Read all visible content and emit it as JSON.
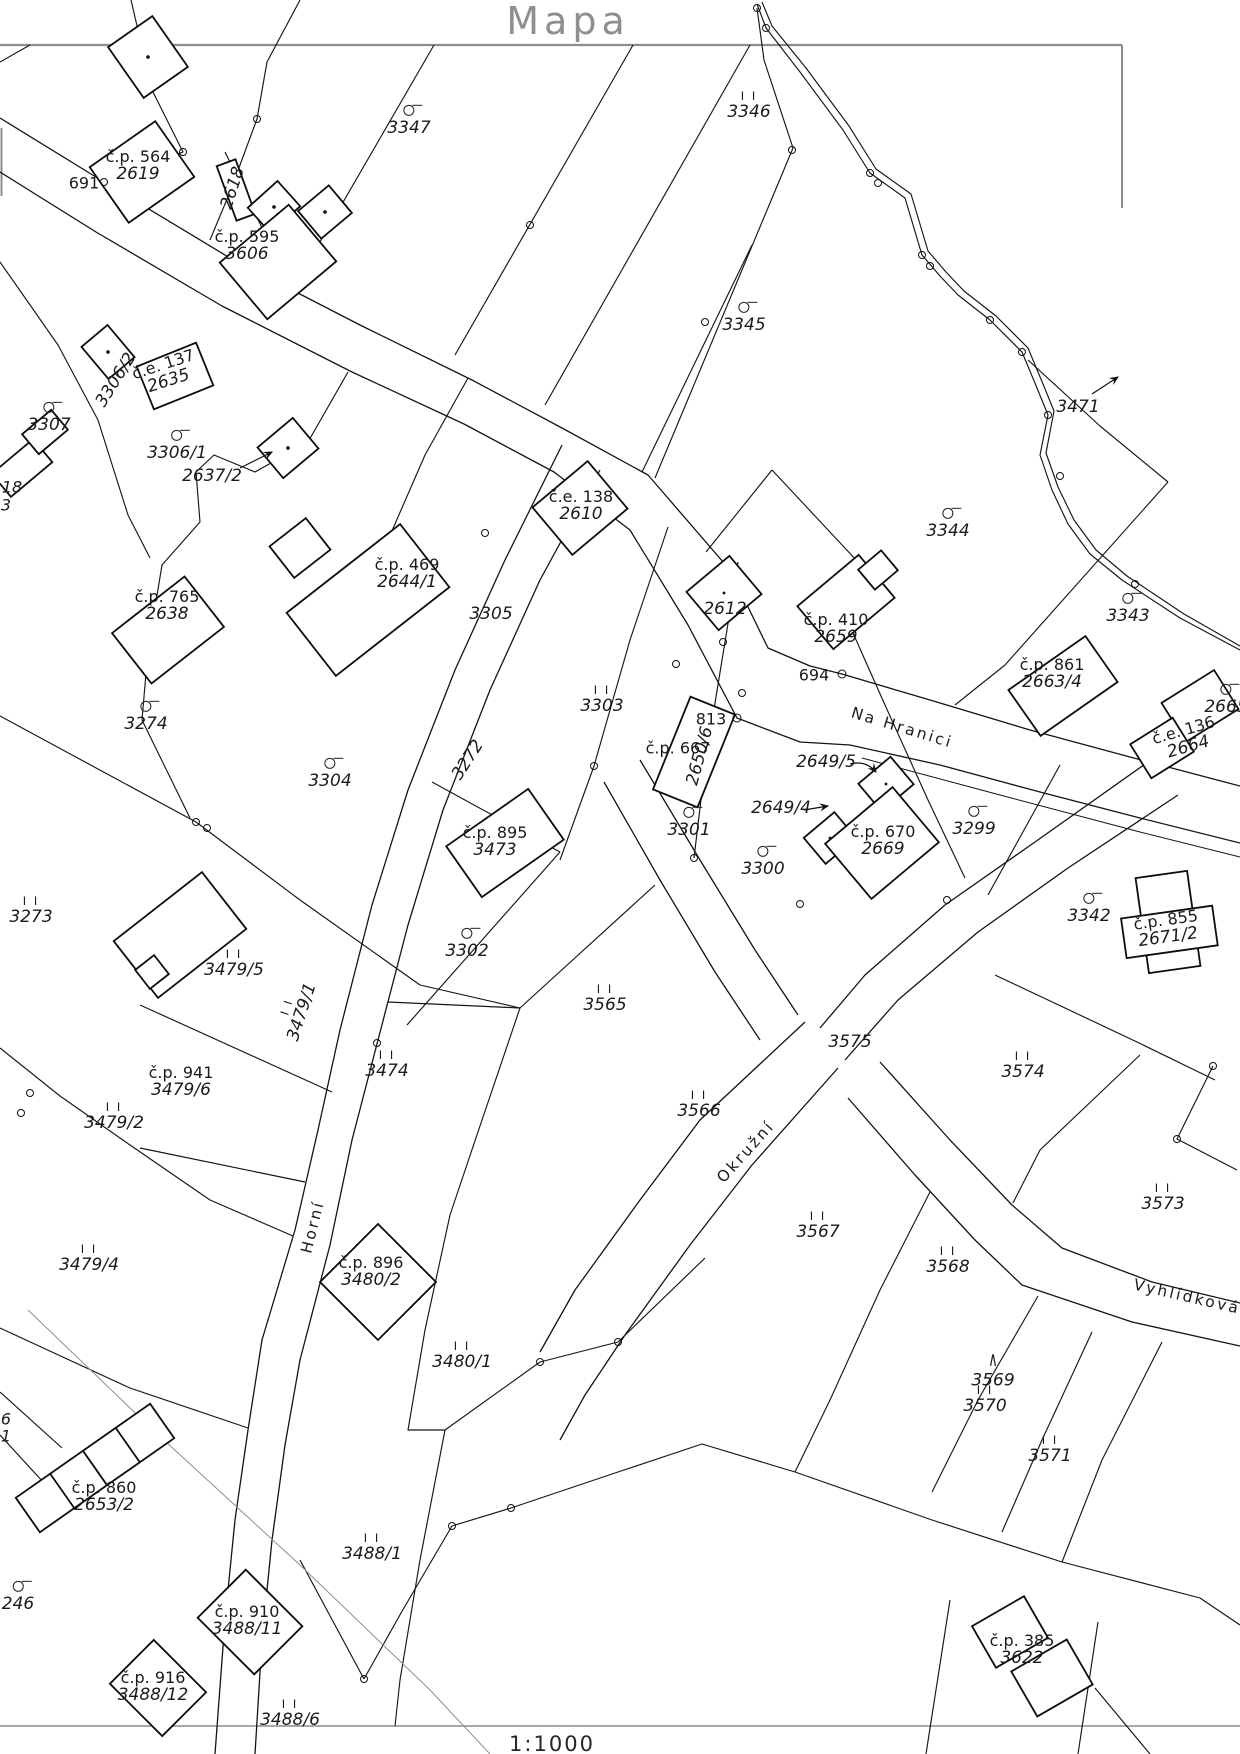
{
  "title": "Mapa",
  "scale_label": "1:1000",
  "streets": [
    {
      "name": "Na Hranici",
      "x": 902,
      "y": 728,
      "rot": 17
    },
    {
      "name": "Okružní",
      "x": 746,
      "y": 1152,
      "rot": -48
    },
    {
      "name": "Horní",
      "x": 313,
      "y": 1227,
      "rot": -76
    },
    {
      "name": "Vyhlídková",
      "x": 1187,
      "y": 1297,
      "rot": 13
    }
  ],
  "parcels": [
    {
      "t": "3347",
      "x": 409,
      "y": 121,
      "s": "c"
    },
    {
      "t": "3346",
      "x": 749,
      "y": 106,
      "s": "g"
    },
    {
      "t": "3345",
      "x": 744,
      "y": 318,
      "s": "c"
    },
    {
      "t": "3471",
      "x": 1078,
      "y": 407
    },
    {
      "t": "3344",
      "x": 948,
      "y": 524,
      "s": "c"
    },
    {
      "t": "3343",
      "x": 1128,
      "y": 609,
      "s": "c"
    },
    {
      "t": "3307",
      "x": 49,
      "y": 418,
      "s": "c"
    },
    {
      "t": "3306/1",
      "x": 177,
      "y": 446,
      "s": "c"
    },
    {
      "t": "3306/2",
      "x": 116,
      "y": 380,
      "rot": -58
    },
    {
      "t": "2637/2",
      "x": 212,
      "y": 476
    },
    {
      "t": "2618",
      "x": 233,
      "y": 188,
      "rot": -72
    },
    {
      "t": "3305",
      "x": 491,
      "y": 614
    },
    {
      "t": "3303",
      "x": 602,
      "y": 700,
      "s": "g"
    },
    {
      "t": "2612",
      "x": 725,
      "y": 609
    },
    {
      "t": "3304",
      "x": 330,
      "y": 774,
      "s": "c"
    },
    {
      "t": "3274",
      "x": 146,
      "y": 717,
      "s": "c"
    },
    {
      "t": "3273",
      "x": 31,
      "y": 911,
      "s": "g"
    },
    {
      "t": "3272",
      "x": 468,
      "y": 760,
      "rot": -57
    },
    {
      "t": "2650/6",
      "x": 700,
      "y": 756,
      "rot": -75
    },
    {
      "t": "2649/5",
      "x": 826,
      "y": 762
    },
    {
      "t": "2649/4",
      "x": 781,
      "y": 808
    },
    {
      "t": "3301",
      "x": 689,
      "y": 823,
      "s": "c"
    },
    {
      "t": "3300",
      "x": 763,
      "y": 862,
      "s": "c"
    },
    {
      "t": "3299",
      "x": 974,
      "y": 822,
      "s": "c"
    },
    {
      "t": "3342",
      "x": 1089,
      "y": 909,
      "s": "c"
    },
    {
      "t": "2665",
      "x": 1226,
      "y": 700,
      "s": "c"
    },
    {
      "t": "3302",
      "x": 467,
      "y": 944,
      "s": "c"
    },
    {
      "t": "3479/5",
      "x": 234,
      "y": 964,
      "s": "g"
    },
    {
      "t": "3479/1",
      "x": 296,
      "y": 1010,
      "s": "g",
      "rot": -72
    },
    {
      "t": "3479/2",
      "x": 114,
      "y": 1117,
      "s": "g"
    },
    {
      "t": "3479/4",
      "x": 89,
      "y": 1259,
      "s": "g"
    },
    {
      "t": "3565",
      "x": 605,
      "y": 999,
      "s": "g"
    },
    {
      "t": "3474",
      "x": 387,
      "y": 1065,
      "s": "g"
    },
    {
      "t": "3566",
      "x": 699,
      "y": 1105,
      "s": "g"
    },
    {
      "t": "3575",
      "x": 850,
      "y": 1042
    },
    {
      "t": "3574",
      "x": 1023,
      "y": 1066,
      "s": "g"
    },
    {
      "t": "3573",
      "x": 1163,
      "y": 1198,
      "s": "g"
    },
    {
      "t": "3567",
      "x": 818,
      "y": 1226,
      "s": "g"
    },
    {
      "t": "3568",
      "x": 948,
      "y": 1261,
      "s": "g"
    },
    {
      "t": "3569",
      "x": 993,
      "y": 1372,
      "s": "t"
    },
    {
      "t": "3570",
      "x": 985,
      "y": 1400,
      "s": "g"
    },
    {
      "t": "3571",
      "x": 1050,
      "y": 1450,
      "s": "g"
    },
    {
      "t": "3480/1",
      "x": 462,
      "y": 1356,
      "s": "g"
    },
    {
      "t": "3488/1",
      "x": 372,
      "y": 1548,
      "s": "g"
    },
    {
      "t": "3488/6",
      "x": 290,
      "y": 1714,
      "s": "g"
    },
    {
      "t": "246",
      "x": 18,
      "y": 1597,
      "s": "c"
    }
  ],
  "buildings": [
    {
      "a": "č.p. 564",
      "b": "2619",
      "x": 138,
      "y": 166
    },
    {
      "a": "č.p. 595",
      "b": "3606",
      "x": 247,
      "y": 246
    },
    {
      "a": "č.e. 137",
      "b": "2635",
      "x": 166,
      "y": 373,
      "rot": -18
    },
    {
      "a": "č.e. 138",
      "b": "2610",
      "x": 581,
      "y": 506
    },
    {
      "a": "č.p. 469",
      "b": "2644/1",
      "x": 407,
      "y": 574
    },
    {
      "a": "č.p. 765",
      "b": "2638",
      "x": 167,
      "y": 606
    },
    {
      "a": "č.p. 410",
      "b": "2659",
      "x": 836,
      "y": 629
    },
    {
      "a": "č.p. 667",
      "b": "",
      "x": 678,
      "y": 748
    },
    {
      "a": "č.p. 861",
      "b": "2663/4",
      "x": 1052,
      "y": 674
    },
    {
      "a": "č.e. 136",
      "b": "2664",
      "x": 1186,
      "y": 739,
      "rot": -16
    },
    {
      "a": "č.p. 670",
      "b": "2669",
      "x": 883,
      "y": 841
    },
    {
      "a": "č.p. 895",
      "b": "3473",
      "x": 495,
      "y": 842
    },
    {
      "a": "č.p. 855",
      "b": "2671/2",
      "x": 1167,
      "y": 929,
      "rot": -8
    },
    {
      "a": "č.p. 941",
      "b": "3479/6",
      "x": 181,
      "y": 1082
    },
    {
      "a": "č.p. 896",
      "b": "3480/2",
      "x": 371,
      "y": 1272
    },
    {
      "a": "č.p. 860",
      "b": "2653/2",
      "x": 104,
      "y": 1497
    },
    {
      "a": "č.p. 910",
      "b": "3488/11",
      "x": 247,
      "y": 1621
    },
    {
      "a": "č.p. 916",
      "b": "3488/12",
      "x": 153,
      "y": 1687
    },
    {
      "a": "č.p. 385",
      "b": "3622",
      "x": 1022,
      "y": 1650
    }
  ],
  "points": [
    {
      "t": "691",
      "x": 84,
      "y": 183
    },
    {
      "t": "694",
      "x": 814,
      "y": 675
    },
    {
      "t": "813",
      "x": 711,
      "y": 719
    }
  ],
  "partials": [
    {
      "t": "18",
      "x": 12,
      "y": 487
    },
    {
      "t": "3",
      "x": 6,
      "y": 505
    },
    {
      "t": "6",
      "x": 6,
      "y": 1419
    },
    {
      "t": "1",
      "x": 6,
      "y": 1436
    }
  ]
}
